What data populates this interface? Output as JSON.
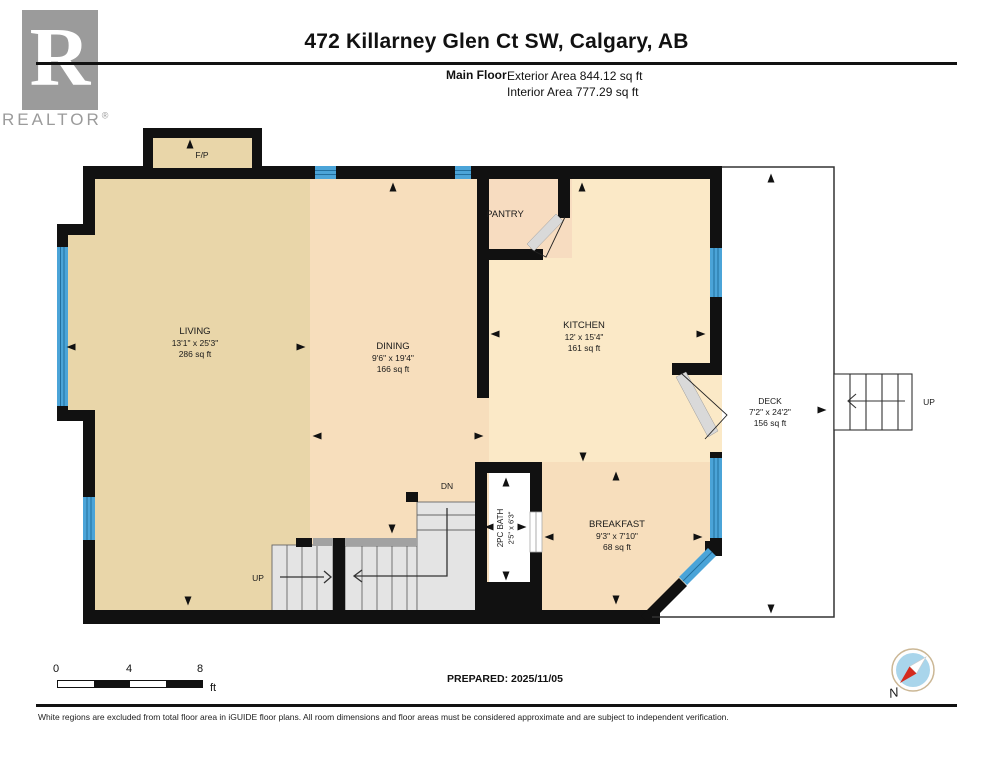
{
  "header": {
    "title": "472 Killarney Glen Ct SW, Calgary, AB",
    "floor_label": "Main Floor",
    "exterior_area": "Exterior Area 844.12 sq ft",
    "interior_area": "Interior Area 777.29 sq ft"
  },
  "logo": {
    "letter": "R",
    "text": "REALTOR",
    "mark": "®"
  },
  "rooms": {
    "living": {
      "name": "LIVING",
      "dims": "13'1\" x 25'3\"",
      "area": "286 sq ft"
    },
    "dining": {
      "name": "DINING",
      "dims": "9'6\" x 19'4\"",
      "area": "166 sq ft"
    },
    "kitchen": {
      "name": "KITCHEN",
      "dims": "12' x 15'4\"",
      "area": "161 sq ft"
    },
    "breakfast": {
      "name": "BREAKFAST",
      "dims": "9'3\" x 7'10\"",
      "area": "68 sq ft"
    },
    "deck": {
      "name": "DECK",
      "dims": "7'2\" x 24'2\"",
      "area": "156 sq ft"
    },
    "bath": {
      "name": "2PC BATH",
      "dims": "2'5\" x 6'3\""
    },
    "pantry": {
      "name": "PANTRY"
    },
    "fireplace": {
      "name": "F/P"
    }
  },
  "stairs": {
    "up": "UP",
    "down": "DN",
    "exterior_up": "UP"
  },
  "scale_bar": {
    "tick0": "0",
    "tick1": "4",
    "tick2": "8",
    "unit": "ft"
  },
  "prepared_label": "PREPARED: 2025/11/05",
  "compass": {
    "north": "N"
  },
  "footer": {
    "disclaimer": "White regions are excluded from total floor area in iGUIDE floor plans. All room dimensions and floor areas must be considered approximate and are subject to independent verification."
  },
  "colors": {
    "living_fill": "#e9d6a9",
    "peach_fill": "#f7debc",
    "kitchen_fill": "#fbe9c7",
    "wall": "#111111",
    "window_blue": "#4ba4d8",
    "stair_gray": "#e4e4e4"
  }
}
